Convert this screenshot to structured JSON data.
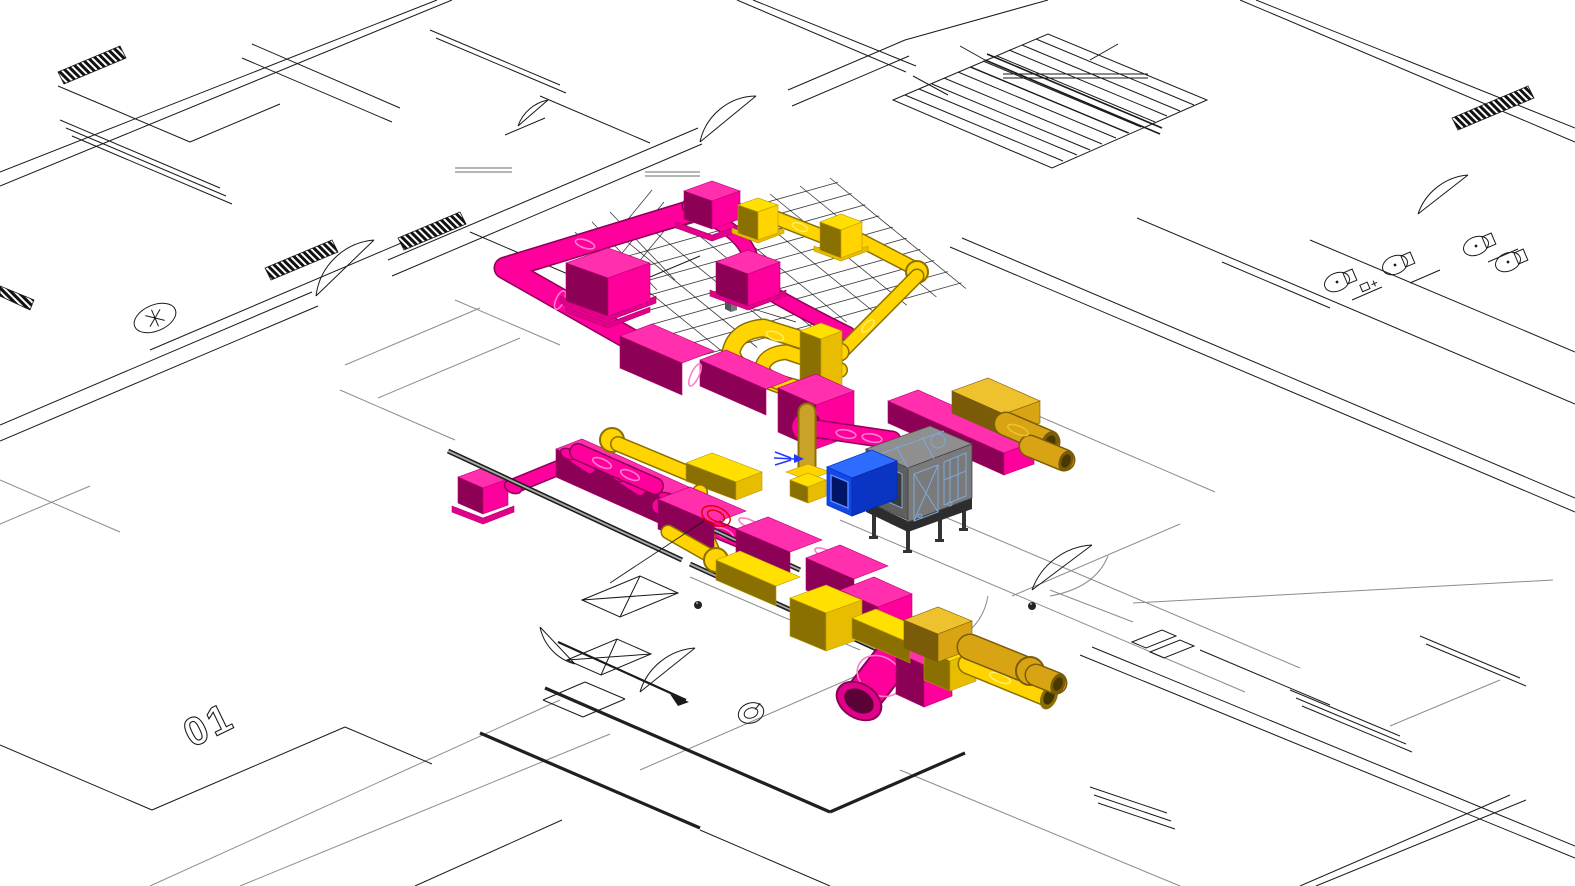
{
  "app": {
    "title": "3D HVAC coordination view",
    "view_type": "isometric 3D view over floor plan underlay"
  },
  "plan": {
    "floor_label": "01",
    "features": [
      "staircase",
      "wc-fixtures",
      "door-swings",
      "window-walls",
      "shaft-cross-boxes",
      "corridor-walls",
      "ceiling-grid"
    ]
  },
  "systems": {
    "supply": {
      "name": "Supply ductwork",
      "color_key": "pink-side"
    },
    "extract": {
      "name": "Extract ductwork",
      "color_key": "yel-side"
    },
    "extract_shaded": {
      "name": "Extract ductwork (shaded)",
      "color_key": "gold-side"
    },
    "equipment": [
      {
        "name": "Air handling unit",
        "color_key": "ahu-top"
      },
      {
        "name": "Duct attenuator",
        "color_key": "blue-side"
      }
    ]
  },
  "annotations": {
    "marker_icon": "red-ellipse-marker",
    "flow_icon": "blue-flow-arrow",
    "section_icon": "section-cut-arrow"
  },
  "colors": {
    "bg": "#FFFFFF",
    "plan-line": "#1A1A1A",
    "plan-gray": "#8C8C8C",
    "wall-dark": "#1F1F1F",
    "pink-top": "#FF2FAE",
    "pink-side": "#FF009C",
    "pink-mid": "#E00089",
    "pink-dark": "#8C0056",
    "pink-edge": "#B8006F",
    "pink-ring": "#FF7DCB",
    "pink-hole": "#5C0038",
    "yel-top": "#FFE001",
    "yel-side": "#FFD400",
    "yel-mid": "#E8BC00",
    "yel-dark": "#8A7000",
    "yel-edge": "#B89800",
    "yel-ring": "#FFF06E",
    "gold-top": "#EDC22E",
    "gold-side": "#D9A414",
    "gold-dark": "#7A5C08",
    "gold-hole": "#4A3800",
    "tan": "#C9A227",
    "ahu-top": "#8F8F8F",
    "ahu-left": "#5F5F5F",
    "ahu-right": "#7A7A7A",
    "ahu-base": "#2D2D2D",
    "ahu-dark": "#3A3A3A",
    "wire-blue": "#7FA8DC",
    "blue-top": "#2E6BFF",
    "blue-side": "#1247E8",
    "blue-dark": "#0A34C4",
    "blue-inset": "#001566",
    "blue-inset-edge": "#5E8CFF",
    "anno-red": "#E10000",
    "anno-blue": "#2238FF"
  }
}
